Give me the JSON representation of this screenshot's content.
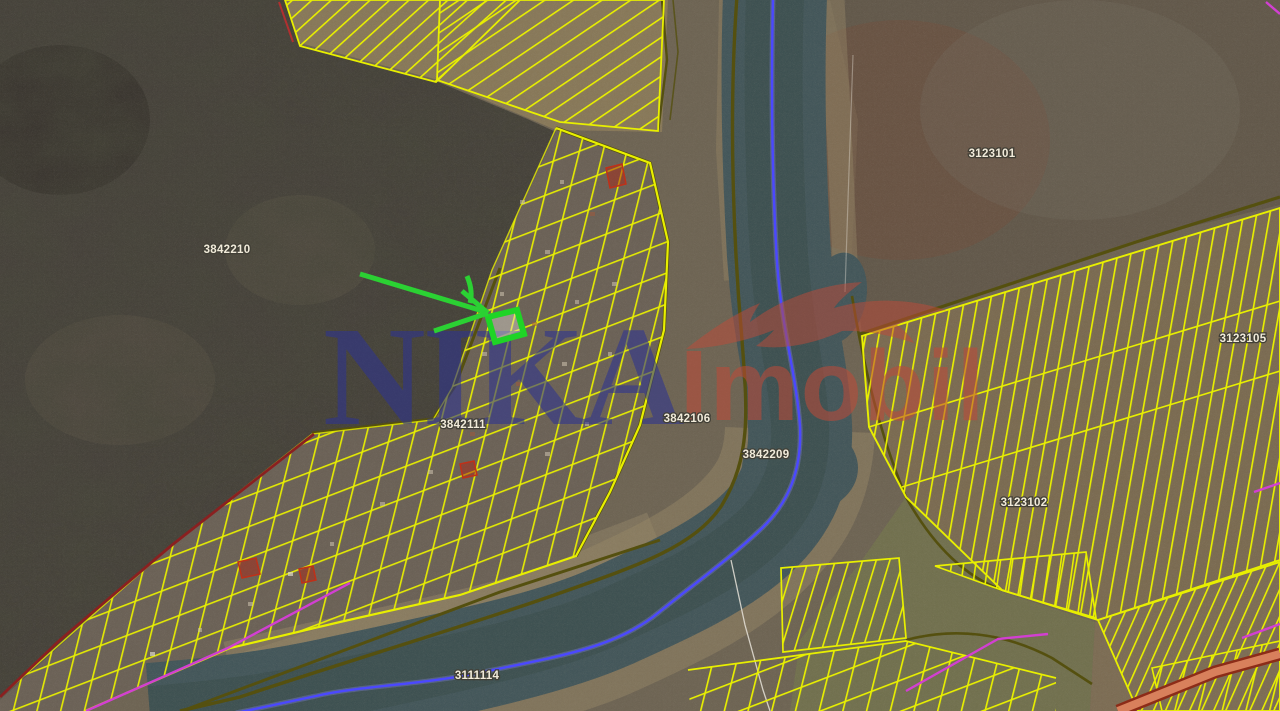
{
  "map_meta": {
    "kind": "satellite-cadastral-map",
    "selected_parcel_highlighted": true
  },
  "watermark": {
    "primary": "NIKA",
    "secondary": "Imobil",
    "primary_color": "#2e3490",
    "secondary_color": "#bf4a38"
  },
  "parcel_labels": [
    {
      "id": "3842210"
    },
    {
      "id": "3123101"
    },
    {
      "id": "3842111"
    },
    {
      "id": "3842106"
    },
    {
      "id": "3842209"
    },
    {
      "id": "3111114"
    },
    {
      "id": "3123102"
    },
    {
      "id": "3123105"
    }
  ],
  "highlight": {
    "selected_parcel_color": "#1fd426",
    "arrow_color": "#2bd133"
  },
  "layers": {
    "parcel_line_color": "#e8ef00",
    "admin_boundary_color": "#4b48ff",
    "road_line_color": "#55500f",
    "zone_line_color": "#d23fd2",
    "restricted_line_color": "#8a2020"
  }
}
